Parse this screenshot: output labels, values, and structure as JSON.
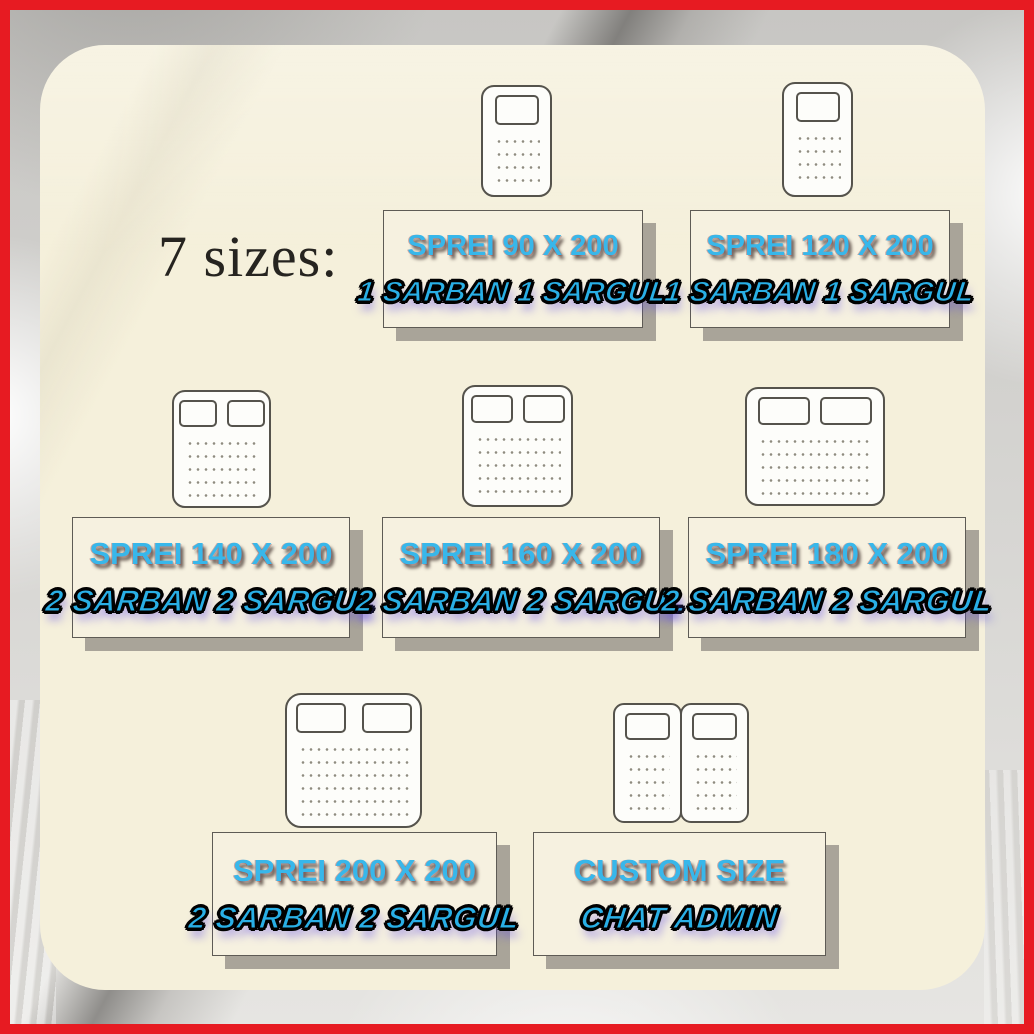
{
  "title": "7 sizes:",
  "cards": [
    {
      "size_label": "SPREI 90 X 200",
      "qty_label": "1 SARBAN 1 SARGUL",
      "bed_type": "single-1-pillow"
    },
    {
      "size_label": "SPREI 120 X 200",
      "qty_label": "1 SARBAN 1 SARGUL",
      "bed_type": "single-1-pillow"
    },
    {
      "size_label": "SPREI 140 X 200",
      "qty_label": "2 SARBAN 2 SARGUL",
      "bed_type": "double-2-pillows"
    },
    {
      "size_label": "SPREI 160 X 200",
      "qty_label": "2 SARBAN 2 SARGUL",
      "bed_type": "double-2-pillows"
    },
    {
      "size_label": "SPREI 180 X 200",
      "qty_label": "2 SARBAN 2 SARGUL",
      "bed_type": "double-2-pillows"
    },
    {
      "size_label": "SPREI 200 X 200",
      "qty_label": "2 SARBAN 2 SARGUL",
      "bed_type": "queen-2-pillows"
    },
    {
      "size_label": "CUSTOM SIZE",
      "qty_label": "CHAT ADMIN",
      "bed_type": "twin-side-by-side"
    }
  ],
  "colors": {
    "frame_red": "#e71b22",
    "panel_cream": "#f5f0db",
    "label_cream": "#f6f1e0",
    "accent_cyan": "#38b7ea",
    "accent_cyan_dark": "#29afe6",
    "label_shadow_gray": "#a9a499",
    "line_dark": "#55534c",
    "title_dark": "#262420"
  }
}
